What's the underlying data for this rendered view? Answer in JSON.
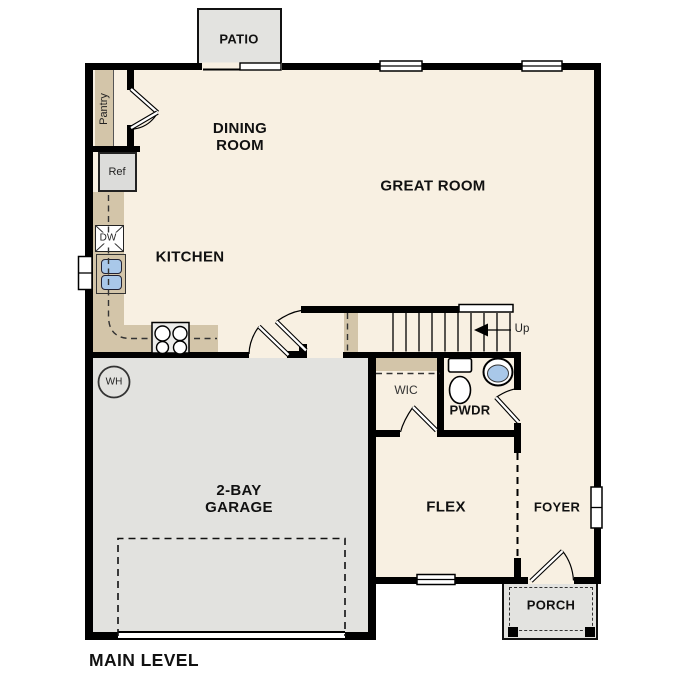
{
  "title": "MAIN LEVEL",
  "rooms": {
    "patio": "PATIO",
    "dining_room": "DINING ROOM",
    "great_room": "GREAT ROOM",
    "kitchen": "KITCHEN",
    "pantry": "Pantry",
    "garage": "2-BAY GARAGE",
    "wic": "WIC",
    "powder": "PWDR",
    "flex": "FLEX",
    "foyer": "FOYER",
    "porch": "PORCH"
  },
  "fixtures": {
    "refrigerator": "Ref",
    "dishwasher": "DW",
    "water_heater": "WH",
    "stairs_direction": "Up"
  },
  "colors": {
    "floor": "#f8f0e2",
    "counter": "#d3c5a9",
    "garage_floor": "#e2e2df",
    "outdoor": "#e3e3e0",
    "sink": "#a9c8e9",
    "wall": "#000000",
    "text": "#111111"
  }
}
